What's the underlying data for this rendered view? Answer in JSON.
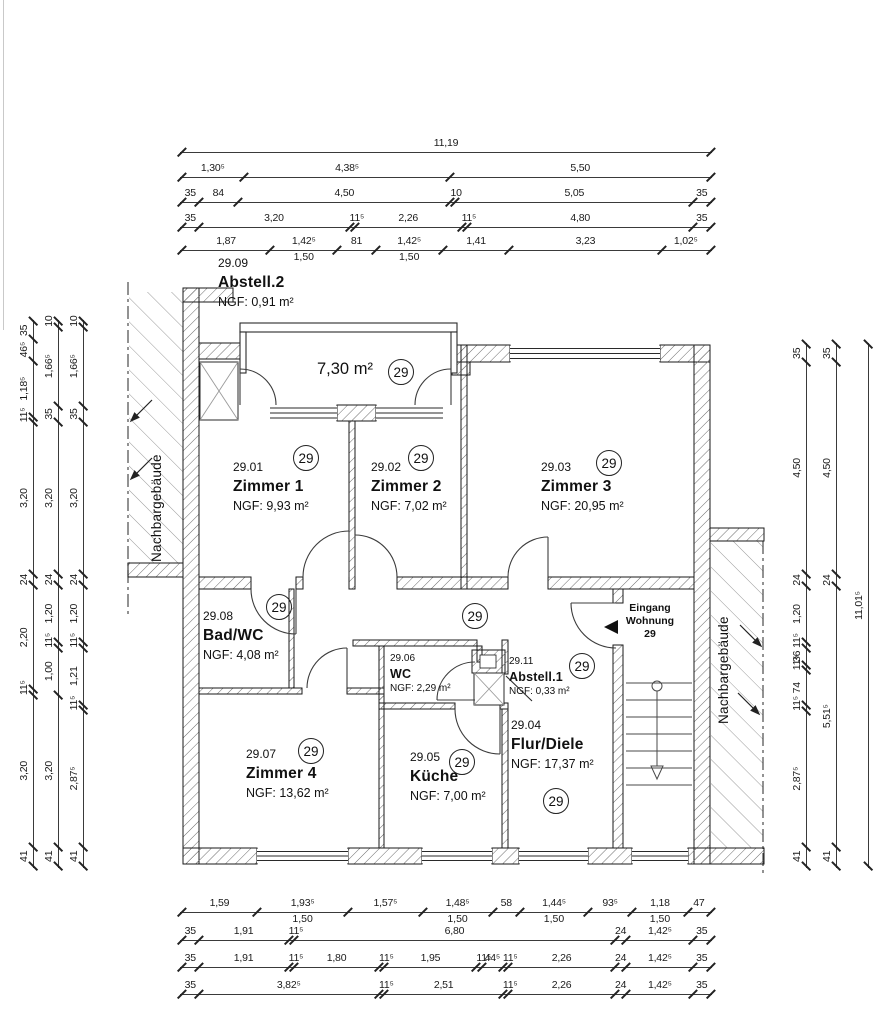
{
  "unit": "29",
  "labels": {
    "neighbor": "Nachbargebäude",
    "entrance": [
      "Eingang",
      "Wohnung",
      "29"
    ],
    "balcony_area": "7,30 m²"
  },
  "rooms": {
    "abstell2": {
      "id": "29.09",
      "name": "Abstell.2",
      "area": "NGF: 0,91 m²"
    },
    "zimmer1": {
      "id": "29.01",
      "name": "Zimmer 1",
      "area": "NGF: 9,93 m²"
    },
    "zimmer2": {
      "id": "29.02",
      "name": "Zimmer 2",
      "area": "NGF: 7,02 m²"
    },
    "zimmer3": {
      "id": "29.03",
      "name": "Zimmer 3",
      "area": "NGF: 20,95 m²"
    },
    "badwc": {
      "id": "29.08",
      "name": "Bad/WC",
      "area": "NGF: 4,08 m²"
    },
    "wc": {
      "id": "29.06",
      "name": "WC",
      "area": "NGF: 2,29 m²"
    },
    "abstell1": {
      "id": "29.11",
      "name": "Abstell.1",
      "area": "NGF: 0,33 m²"
    },
    "flur": {
      "id": "29.04",
      "name": "Flur/Diele",
      "area": "NGF: 17,37 m²"
    },
    "zimmer4": {
      "id": "29.07",
      "name": "Zimmer 4",
      "area": "NGF: 13,62 m²"
    },
    "kueche": {
      "id": "29.05",
      "name": "Küche",
      "area": "NGF: 7,00 m²"
    }
  },
  "dims": {
    "top": [
      {
        "segments": [
          {
            "label": "11,19",
            "value": 11.19
          }
        ]
      },
      {
        "segments": [
          {
            "label": "1,30⁵",
            "value": 1.305
          },
          {
            "label": "4,38⁵",
            "value": 4.385
          },
          {
            "label": "5,50",
            "value": 5.5
          }
        ]
      },
      {
        "segments": [
          {
            "label": "35",
            "value": 0.35
          },
          {
            "label": "84",
            "value": 0.84
          },
          {
            "label": "4,50",
            "value": 4.5
          },
          {
            "label": "10",
            "value": 0.1
          },
          {
            "label": "5,05",
            "value": 5.05
          },
          {
            "label": "35",
            "value": 0.35
          }
        ]
      },
      {
        "segments": [
          {
            "label": "35",
            "value": 0.35
          },
          {
            "label": "3,20",
            "value": 3.2
          },
          {
            "label": "11⁵",
            "value": 0.115
          },
          {
            "label": "2,26",
            "value": 2.26
          },
          {
            "label": "11⁵",
            "value": 0.115
          },
          {
            "label": "4,80",
            "value": 4.8
          },
          {
            "label": "35",
            "value": 0.35
          }
        ]
      },
      {
        "segments": [
          {
            "label": "1,87",
            "value": 1.87
          },
          {
            "label": "1,42⁵",
            "value": 1.425,
            "sub": "1,50"
          },
          {
            "label": "81",
            "value": 0.81
          },
          {
            "label": "1,42⁵",
            "value": 1.425,
            "sub": "1,50"
          },
          {
            "label": "1,41",
            "value": 1.41
          },
          {
            "label": "3,23",
            "value": 3.23
          },
          {
            "label": "1,02⁵",
            "value": 1.025
          }
        ]
      }
    ],
    "bottom": [
      {
        "segments": [
          {
            "label": "1,59",
            "value": 1.59
          },
          {
            "label": "1,93⁵",
            "value": 1.935,
            "sub": "1,50"
          },
          {
            "label": "1,57⁵",
            "value": 1.575
          },
          {
            "label": "1,48⁵",
            "value": 1.485,
            "sub": "1,50"
          },
          {
            "label": "58",
            "value": 0.58
          },
          {
            "label": "1,44⁵",
            "value": 1.445,
            "sub": "1,50"
          },
          {
            "label": "93⁵",
            "value": 0.935
          },
          {
            "label": "1,18",
            "value": 1.18,
            "sub": "1,50"
          },
          {
            "label": "47",
            "value": 0.47
          }
        ]
      },
      {
        "segments": [
          {
            "label": "35",
            "value": 0.35
          },
          {
            "label": "1,91",
            "value": 1.91
          },
          {
            "label": "11⁵",
            "value": 0.115
          },
          {
            "label": "6,80",
            "value": 6.8
          },
          {
            "label": "24",
            "value": 0.24
          },
          {
            "label": "1,42⁵",
            "value": 1.425
          },
          {
            "label": "35",
            "value": 0.35
          }
        ]
      },
      {
        "segments": [
          {
            "label": "35",
            "value": 0.35
          },
          {
            "label": "1,91",
            "value": 1.91
          },
          {
            "label": "11⁵",
            "value": 0.115
          },
          {
            "label": "1,80",
            "value": 1.8
          },
          {
            "label": "11⁵",
            "value": 0.115
          },
          {
            "label": "1,95",
            "value": 1.95
          },
          {
            "label": "11⁵",
            "value": 0.115
          },
          {
            "label": "44⁵",
            "value": 0.445
          },
          {
            "label": "11⁵",
            "value": 0.115
          },
          {
            "label": "2,26",
            "value": 2.26
          },
          {
            "label": "24",
            "value": 0.24
          },
          {
            "label": "1,42⁵",
            "value": 1.425
          },
          {
            "label": "35",
            "value": 0.35
          }
        ]
      },
      {
        "segments": [
          {
            "label": "35",
            "value": 0.35
          },
          {
            "label": "3,82⁵",
            "value": 3.825
          },
          {
            "label": "11⁵",
            "value": 0.115
          },
          {
            "label": "2,51",
            "value": 2.51
          },
          {
            "label": "11⁵",
            "value": 0.115
          },
          {
            "label": "2,26",
            "value": 2.26
          },
          {
            "label": "24",
            "value": 0.24
          },
          {
            "label": "1,42⁵",
            "value": 1.425
          },
          {
            "label": "35",
            "value": 0.35
          }
        ]
      }
    ],
    "left": [
      {
        "segments": [
          {
            "label": "35",
            "value": 0.35
          },
          {
            "label": "46⁵",
            "value": 0.465
          },
          {
            "label": "1,18⁵",
            "value": 1.185
          },
          {
            "label": "11⁵",
            "value": 0.115
          },
          {
            "label": "3,20",
            "value": 3.2
          },
          {
            "label": "24",
            "value": 0.24
          },
          {
            "label": "2,20",
            "value": 2.2
          },
          {
            "label": "11⁵",
            "value": 0.115
          },
          {
            "label": "3,20",
            "value": 3.2
          },
          {
            "label": "41",
            "value": 0.41
          }
        ]
      },
      {
        "segments": [
          {
            "label": "10",
            "value": 0.1
          },
          {
            "label": "1,66⁵",
            "value": 1.665
          },
          {
            "label": "35",
            "value": 0.35
          },
          {
            "label": "3,20",
            "value": 3.2
          },
          {
            "label": "24",
            "value": 0.24
          },
          {
            "label": "1,20",
            "value": 1.2
          },
          {
            "label": "11⁵",
            "value": 0.115
          },
          {
            "label": "1,00",
            "value": 1.0
          },
          {
            "label": "3,20",
            "value": 3.2
          },
          {
            "label": "41",
            "value": 0.41
          }
        ]
      },
      {
        "segments": [
          {
            "label": "10",
            "value": 0.1
          },
          {
            "label": "1,66⁵",
            "value": 1.665
          },
          {
            "label": "35",
            "value": 0.35
          },
          {
            "label": "3,20",
            "value": 3.2
          },
          {
            "label": "24",
            "value": 0.24
          },
          {
            "label": "1,20",
            "value": 1.2
          },
          {
            "label": "11⁵",
            "value": 0.115
          },
          {
            "label": "1,21",
            "value": 1.21
          },
          {
            "label": "11⁵",
            "value": 0.115
          },
          {
            "label": "2,87⁵",
            "value": 2.875
          },
          {
            "label": "41",
            "value": 0.41
          }
        ]
      }
    ],
    "right": [
      {
        "segments": [
          {
            "label": "35",
            "value": 0.35
          },
          {
            "label": "4,50",
            "value": 4.5
          },
          {
            "label": "24",
            "value": 0.24
          },
          {
            "label": "1,20",
            "value": 1.2
          },
          {
            "label": "11⁵",
            "value": 0.115
          },
          {
            "label": "36",
            "value": 0.36
          },
          {
            "label": "11⁵",
            "value": 0.115
          },
          {
            "label": "74",
            "value": 0.74
          },
          {
            "label": "11⁵",
            "value": 0.115
          },
          {
            "label": "2,87⁵",
            "value": 2.875
          },
          {
            "label": "41",
            "value": 0.41
          }
        ]
      },
      {
        "segments": [
          {
            "label": "35",
            "value": 0.35
          },
          {
            "label": "4,50",
            "value": 4.5
          },
          {
            "label": "24",
            "value": 0.24
          },
          {
            "label": "5,51⁵",
            "value": 5.515
          },
          {
            "label": "41",
            "value": 0.41
          }
        ]
      },
      {
        "segments": [
          {
            "label": "11,01⁵",
            "value": 11.015
          }
        ]
      }
    ]
  }
}
